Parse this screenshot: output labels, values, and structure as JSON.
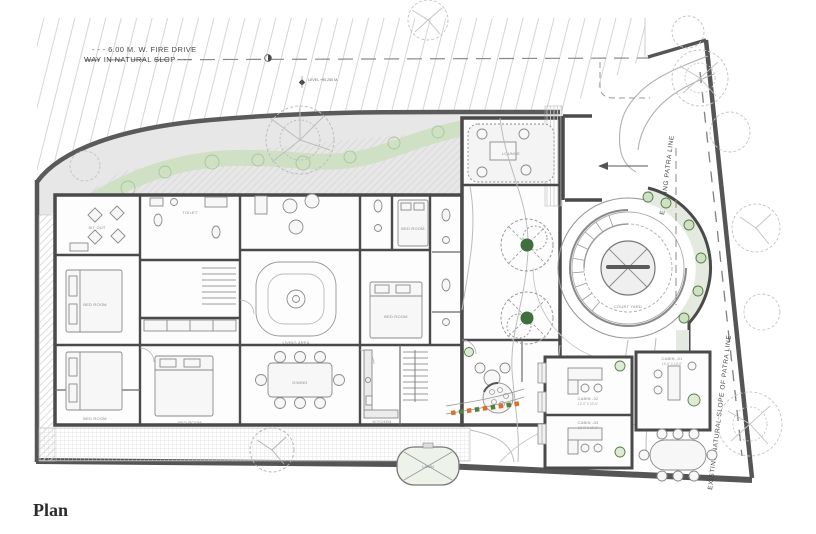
{
  "title": {
    "plan": "Plan"
  },
  "annotations": {
    "fire_drive_1": "- - - 6.00 M. W. FIRE DRIVE",
    "fire_drive_2": "WAY IN NATURAL SLOP - - -",
    "level_marker": "LEVEL +90.250 M.",
    "path_top": "EXISTING PATRA LINE",
    "path_bottom": "EXISTING NATURAL SLOPE OF PATRA LINE"
  },
  "rooms": {
    "sitout": "SIT OUT",
    "bed1": "BED ROOM",
    "bed2": "BED ROOM",
    "bed3": "BED ROOM",
    "bed4": "BED ROOM",
    "bed5": "BED ROOM",
    "toilet": "TOILET",
    "living": "LIVING AREA",
    "dining": "DINING",
    "kitchen": "KITCHEN",
    "lounge": "LOUNGE",
    "court": "COURT YARD",
    "lawn": "LAWN"
  },
  "cabins": [
    {
      "label": "CABIN -01",
      "dim": "14'-0\" X 10'-0\""
    },
    {
      "label": "CABIN -02",
      "dim": "12'-0\" X 10'-0\""
    },
    {
      "label": "CABIN -03",
      "dim": "12'-0\" X 10'-0\""
    }
  ],
  "colors": {
    "wall": "#4a4a4a",
    "boundary": "#555555",
    "green_strip": "#cfe0c4",
    "plant_green": "#53803f",
    "flower_orange": "#d9702c",
    "drive_gray": "#e7e7e7"
  }
}
